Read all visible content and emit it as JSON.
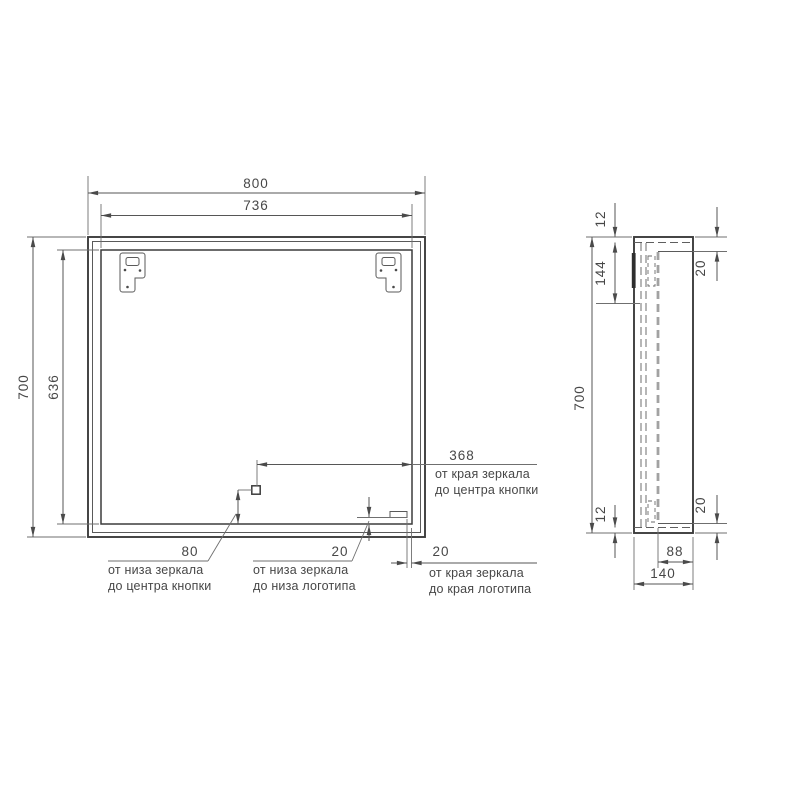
{
  "front_view": {
    "dim_width_outer": "800",
    "dim_width_inner": "736",
    "dim_height_outer": "700",
    "dim_height_inner": "636",
    "dim_button_from_edge": "368",
    "dim_button_from_bottom": "80",
    "dim_logo_from_bottom": "20",
    "dim_logo_from_edge": "20",
    "label_button_edge_line1": "от края зеркала",
    "label_button_edge_line2": "до центра кнопки",
    "label_button_bottom_line1": "от низа зеркала",
    "label_button_bottom_line2": "до центра кнопки",
    "label_logo_bottom_line1": "от низа зеркала",
    "label_logo_bottom_line2": "до низа логотипа",
    "label_logo_edge_line1": "от края зеркала",
    "label_logo_edge_line2": "до края логотипа"
  },
  "side_view": {
    "dim_top_inset": "12",
    "dim_bracket_zone": "144",
    "dim_glass_top_inset": "20",
    "dim_height": "700",
    "dim_bottom_inset": "12",
    "dim_glass_bottom_inset": "20",
    "dim_inner_depth": "88",
    "dim_depth": "140"
  },
  "colors": {
    "line": "#3c3c3c",
    "thin_line": "#6f6f6f",
    "hidden_line": "#a2a2a2",
    "text": "#474747",
    "background": "#ffffff"
  }
}
